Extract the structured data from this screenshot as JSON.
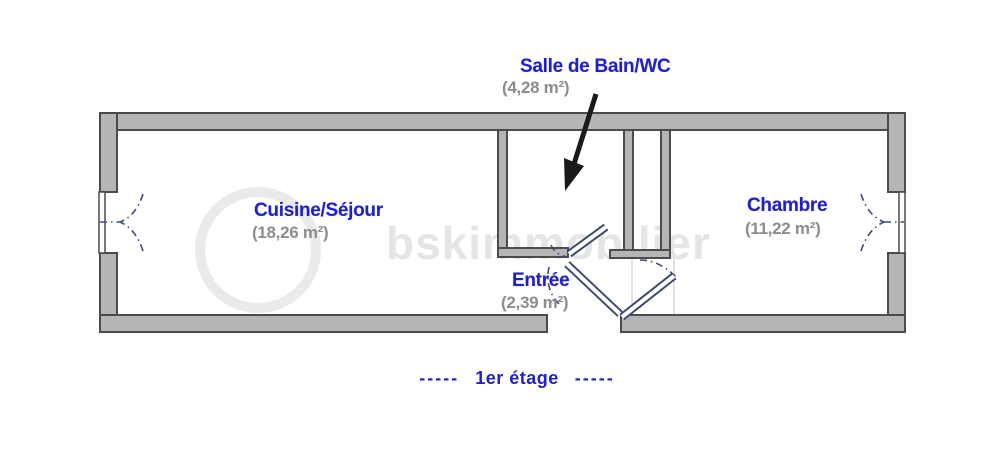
{
  "rooms": {
    "bathroom": {
      "name": "Salle de Bain/WC",
      "area": "(4,28 m²)"
    },
    "living": {
      "name": "Cuisine/Séjour",
      "area": "(18,26 m²)"
    },
    "bedroom": {
      "name": "Chambre",
      "area": "(11,22 m²)"
    },
    "entry": {
      "name": "Entrée",
      "area": "(2,39 m²)"
    }
  },
  "floor": {
    "dashes": "-----",
    "label": "1er étage"
  },
  "watermark": "bskimmobilier",
  "colors": {
    "label_blue": "#2222c4",
    "area_gray": "#8d8d8d",
    "wall_fill": "#b5b5b5",
    "wall_outline": "#4b4b4b",
    "door_stroke": "#3f4a70",
    "arrow_black": "#1a1a1a"
  }
}
